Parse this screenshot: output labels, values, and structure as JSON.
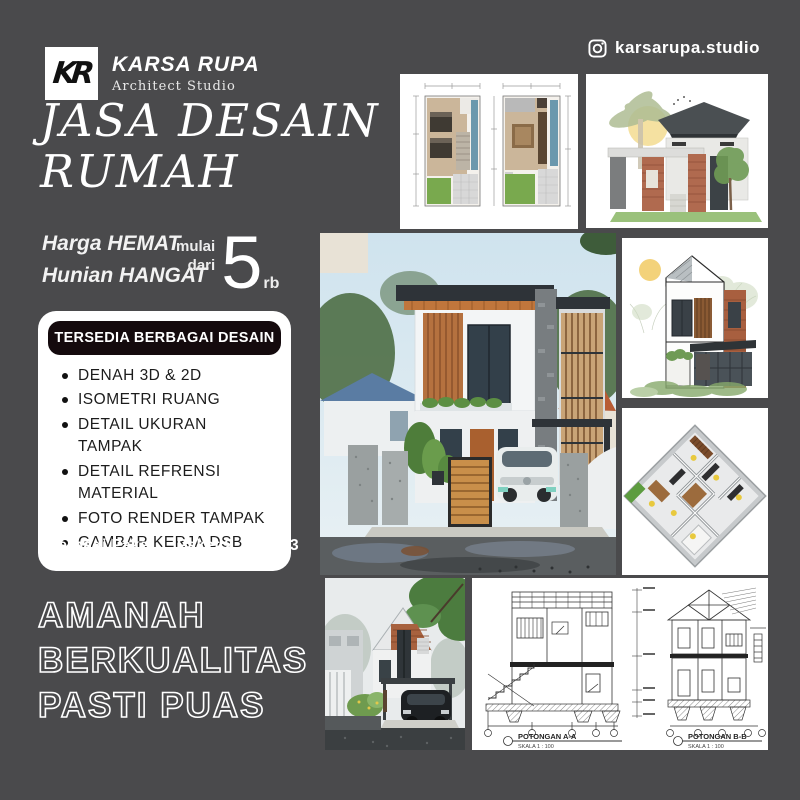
{
  "header": {
    "logo": {
      "monogram": "KR",
      "name": "KARSA RUPA",
      "subtitle": "Architect Studio"
    },
    "instagram": {
      "handle": "karsarupa.studio",
      "icon": "instagram-icon"
    }
  },
  "hero": {
    "title_line1": "JASA DESAIN",
    "title_line2": "RUMAH",
    "tagline_line1": "Harga HEMAT",
    "tagline_line2": "Hunian HANGAT",
    "price": {
      "prefix_line1": "mulai",
      "prefix_line2": "dari",
      "amount": "5",
      "unit": "rb"
    }
  },
  "features": {
    "badge": "TERSEDIA BERBAGAI DESAIN",
    "items": [
      "DENAH 3D & 2D",
      "ISOMETRI RUANG",
      "DETAIL UKURAN TAMPAK",
      "DETAIL REFRENSI MATERIAL",
      "FOTO RENDER TAMPAK",
      "GAMBAR KERJA DSB"
    ],
    "footnote": "* terbagi Paket 1, Paket 2, Paket 3"
  },
  "slogan": {
    "line1": "AMANAH",
    "line2": "BERKUALITAS",
    "line3": "PASTI PUAS"
  },
  "gallery": {
    "sections": {
      "label_a": "POTONGAN A-A",
      "scale_a": "SKALA 1 : 100",
      "label_b": "POTONGAN B-B",
      "scale_b": "SKALA 1 : 100"
    }
  },
  "colors": {
    "background": "#4a4a4c",
    "badge_bg": "#140a0d",
    "wood_accent": "#c27a3e",
    "brick": "#a8623f",
    "grass": "#79a94e",
    "sky": "#d4e6ef"
  }
}
